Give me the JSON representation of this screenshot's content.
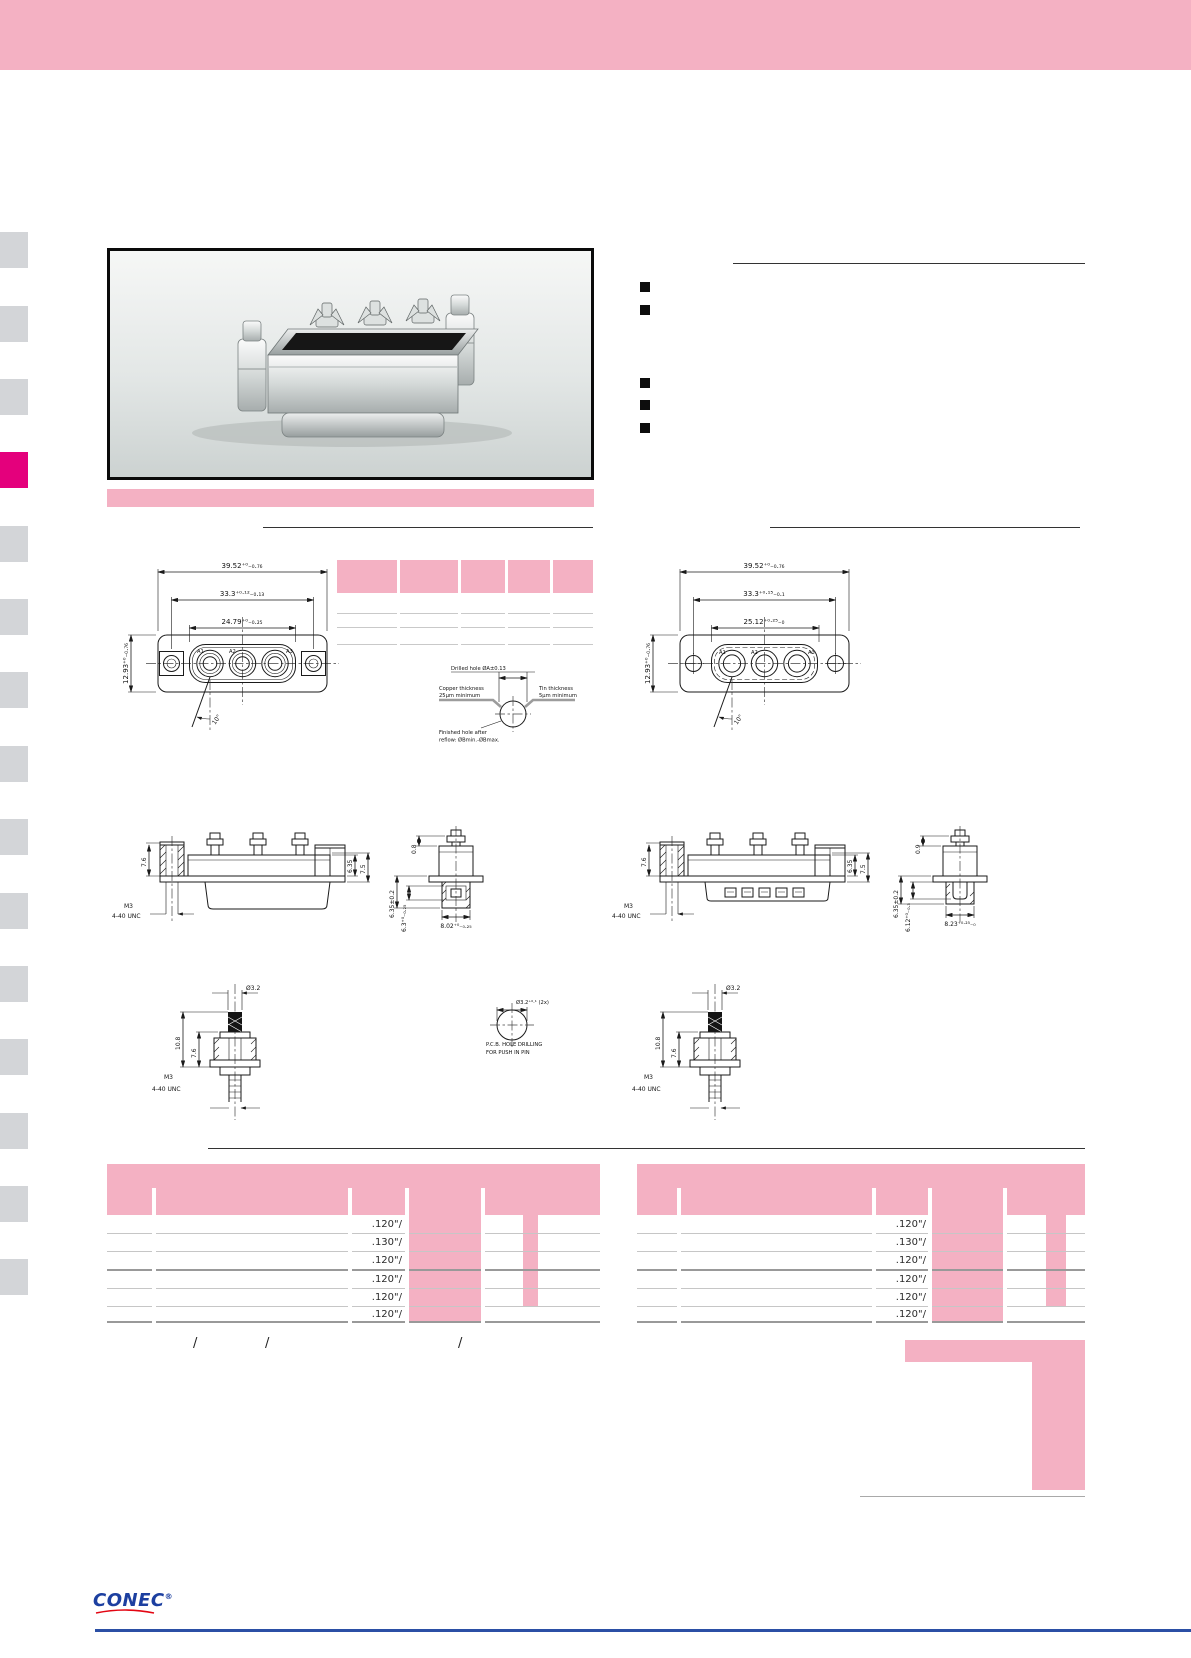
{
  "page": {
    "colors": {
      "pink": "#F4B1C3",
      "magenta": "#E4007C",
      "tab_gray": "#D3D5D8",
      "line_blue": "#2B4FA5",
      "logo_blue": "#1C3FA0",
      "logo_red": "#E30613"
    }
  },
  "drawings": {
    "front_left": {
      "dim_overall": "39.52⁺⁰₋₀.₇₆",
      "dim_holes": "33.3⁺⁰·¹²₋₀.₁₃",
      "dim_insert": "24.79⁺⁰₋₀.₂₅",
      "dim_height": "12.93⁺⁰₋₀.₇₆",
      "angle": "10°",
      "contact_1": "A1",
      "contact_2": "A2",
      "contact_3": "A3"
    },
    "front_right": {
      "dim_overall": "39.52⁺⁰₋₀.₇₆",
      "dim_holes": "33.3⁺⁰·¹⁵₋₀.₁",
      "dim_insert": "25.12⁺⁰·²⁵₋₀",
      "dim_height": "12.93⁺⁰₋₀.₇₆",
      "angle": "10°",
      "contact_1": "A1",
      "contact_2": "A2",
      "contact_3": "A3"
    },
    "drill_detail": {
      "title": "Drilled hole ØA±0.13",
      "copper_1": "Copper thickness",
      "copper_2": "25μm minimum",
      "tin_1": "Tin thickness",
      "tin_2": "5μm minimum",
      "finished_1": "Finished hole after",
      "finished_2": "reflow: ØBmin.-ØBmax."
    },
    "side_left": {
      "standoff_height": "7.6",
      "body_height": "6.35",
      "total_height": "7.5",
      "thread_1": "M3",
      "thread_2": "4-40 UNC"
    },
    "end_left": {
      "offset": "0.8",
      "depth": "6.35±0.2",
      "width_1": "6.3⁺⁰₋₀.₂₅",
      "width_2": "8.02⁺⁰₋₀.₂₅"
    },
    "side_right": {
      "standoff_height": "7.6",
      "body_height": "6.35",
      "total_height": "7.5",
      "thread_1": "M3",
      "thread_2": "4-40 UNC"
    },
    "end_right": {
      "offset": "0.9",
      "depth": "6.35±0.2",
      "width_1": "6.12⁺⁰₋₀.₃",
      "width_2": "8.23⁺⁰·²⁵₋₀"
    },
    "boardlock_left": {
      "pin_dia": "Ø3.2",
      "height_total": "10.8",
      "height_body": "7.6",
      "thread_1": "M3",
      "thread_2": "4-40 UNC"
    },
    "pcb_hole": {
      "dia": "Ø3.2⁺⁰·¹ (2x)",
      "note_1": "P.C.B. HOLE DRILLING",
      "note_2": "FOR PUSH IN PIN"
    },
    "boardlock_right": {
      "pin_dia": "Ø3.2",
      "height_total": "10.8",
      "height_body": "7.6",
      "thread_1": "M3",
      "thread_2": "4-40 UNC"
    }
  },
  "order_tables": {
    "left": {
      "rows": [
        ".120\"/",
        ".130\"/",
        ".120\"/",
        ".120\"/",
        ".120\"/",
        ".120\"/"
      ]
    },
    "right": {
      "rows": [
        ".120\"/",
        ".130\"/",
        ".120\"/",
        ".120\"/",
        ".120\"/",
        ".120\"/"
      ]
    },
    "footnote": {
      "sep_1": "/",
      "sep_2": "/",
      "sep_3": "/"
    }
  },
  "footer": {
    "logo": "CONEC",
    "registered": "®"
  }
}
